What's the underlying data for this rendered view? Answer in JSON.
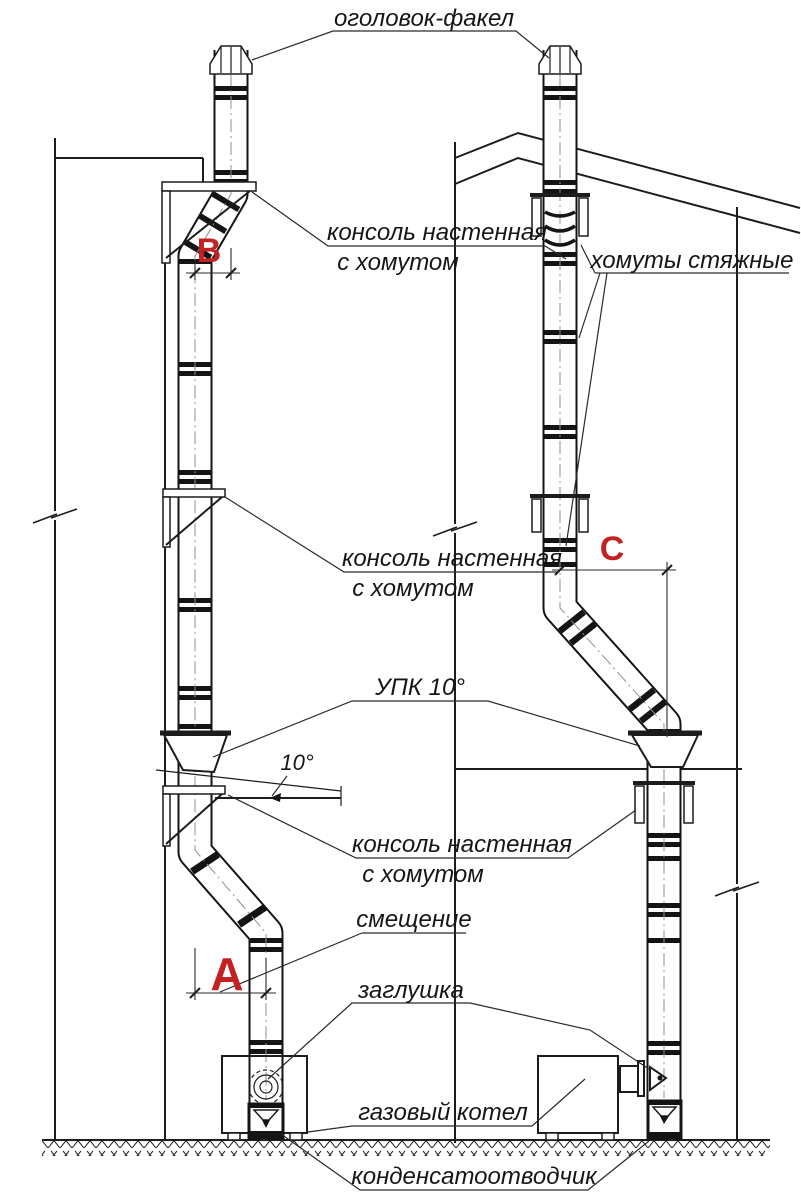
{
  "drawing": {
    "labels": {
      "head_flare": "оголовок-факел",
      "wall_console_line1": "консоль настенная",
      "wall_console_line2": "с хомутом",
      "tie_clamps": "хомуты стяжные",
      "upk": "УПК 10°",
      "angle": "10°",
      "offset": "смещение",
      "plug": "заглушка",
      "gas_boiler": "газовый котел",
      "condensate_trap": "конденсатоотводчик"
    },
    "markers": {
      "a": "A",
      "b": "B",
      "c": "C"
    },
    "colors": {
      "marker_red": "#c32222",
      "line_black": "#1c1c1c",
      "background": "#ffffff"
    }
  }
}
